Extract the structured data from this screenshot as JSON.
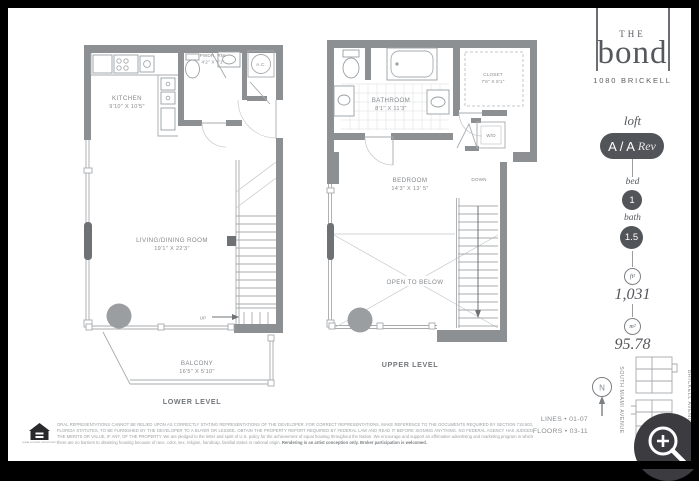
{
  "brand": {
    "the": "THE",
    "name": "bond",
    "address": "1080 BRICKELL"
  },
  "unit": {
    "type_label": "loft",
    "badge_main": "A / A",
    "badge_rev": "Rev",
    "bed_label": "bed",
    "bed_value": "1",
    "bath_label": "bath",
    "bath_value": "1.5",
    "area_ft_unit": "ft²",
    "area_ft_value": "1,031",
    "area_m_unit": "m²",
    "area_m_value": "95.78"
  },
  "plans": {
    "lower": {
      "title": "LOWER LEVEL",
      "kitchen_name": "KITCHEN",
      "kitchen_dims": "9'10\" X 10'5\"",
      "pwdr_name": "PWDR. RM.",
      "pwdr_dims": "4'2\" X 7'1\"",
      "ac_label": "A.C.",
      "living_name": "LIVING/DINING ROOM",
      "living_dims": "19'1\" X 22'3\"",
      "balcony_name": "BALCONY",
      "balcony_dims": "16'5\" X 5'10\"",
      "up_label": "UP"
    },
    "upper": {
      "title": "UPPER LEVEL",
      "bathroom_name": "BATHROOM",
      "bathroom_dims": "8'1\" X 11'3\"",
      "closet_name": "CLOSET",
      "closet_dims": "7'6\" X 8'1\"",
      "wd_label": "W/D",
      "bedroom_name": "BEDROOM",
      "bedroom_dims": "14'3\" X 13' 5\"",
      "open_label": "OPEN TO BELOW",
      "down_label": "DOWN"
    }
  },
  "keyplan": {
    "compass_label": "N",
    "street_left": "SOUTH MIAMI AVENUE",
    "street_right": "BRICKELL AVENUE",
    "lines_label": "LINES • 01-07",
    "floors_label": "FLOORS • 03-11"
  },
  "footer": {
    "equal_housing_label": "EQUAL HOUSING OPPORTUNITY",
    "disclaimer_main": "ORAL REPRESENTATIONS CANNOT BE RELIED UPON AS CORRECTLY STATING REPRESENTATIONS OF THE DEVELOPER. FOR CORRECT REPRESENTATIONS, MAKE REFERENCE TO THE DOCUMENTS REQUIRED BY SECTION 718.503, FLORIDA STATUTES, TO BE FURNISHED BY THE DEVELOPER TO A BUYER OR LESSEE. OBTAIN THE PROPERTY REPORT REQUIRED BY FEDERAL LAW AND READ IT BEFORE SIGNING ANYTHING. NO FEDERAL AGENCY HAS JUDGED THE MERITS OR VALUE, IF ANY, OF THE PROPERTY. We are pledged to the letter and spirit of U.S. policy for the achievement of equal housing throughout the Nation. We encourage and support an affirmative advertising and marketing program in which there are no barriers to obtaining housing because of race, color, sex, religion, handicap, familial status or national origin. ",
    "disclaimer_bold": "Rendering is an artist conception only. Broker participation is welcomed."
  },
  "colors": {
    "wall_gray": "#8d9093",
    "accent_dark": "#515459",
    "frame_black": "#000000",
    "zoom_button_bg": "#3b3b40"
  }
}
